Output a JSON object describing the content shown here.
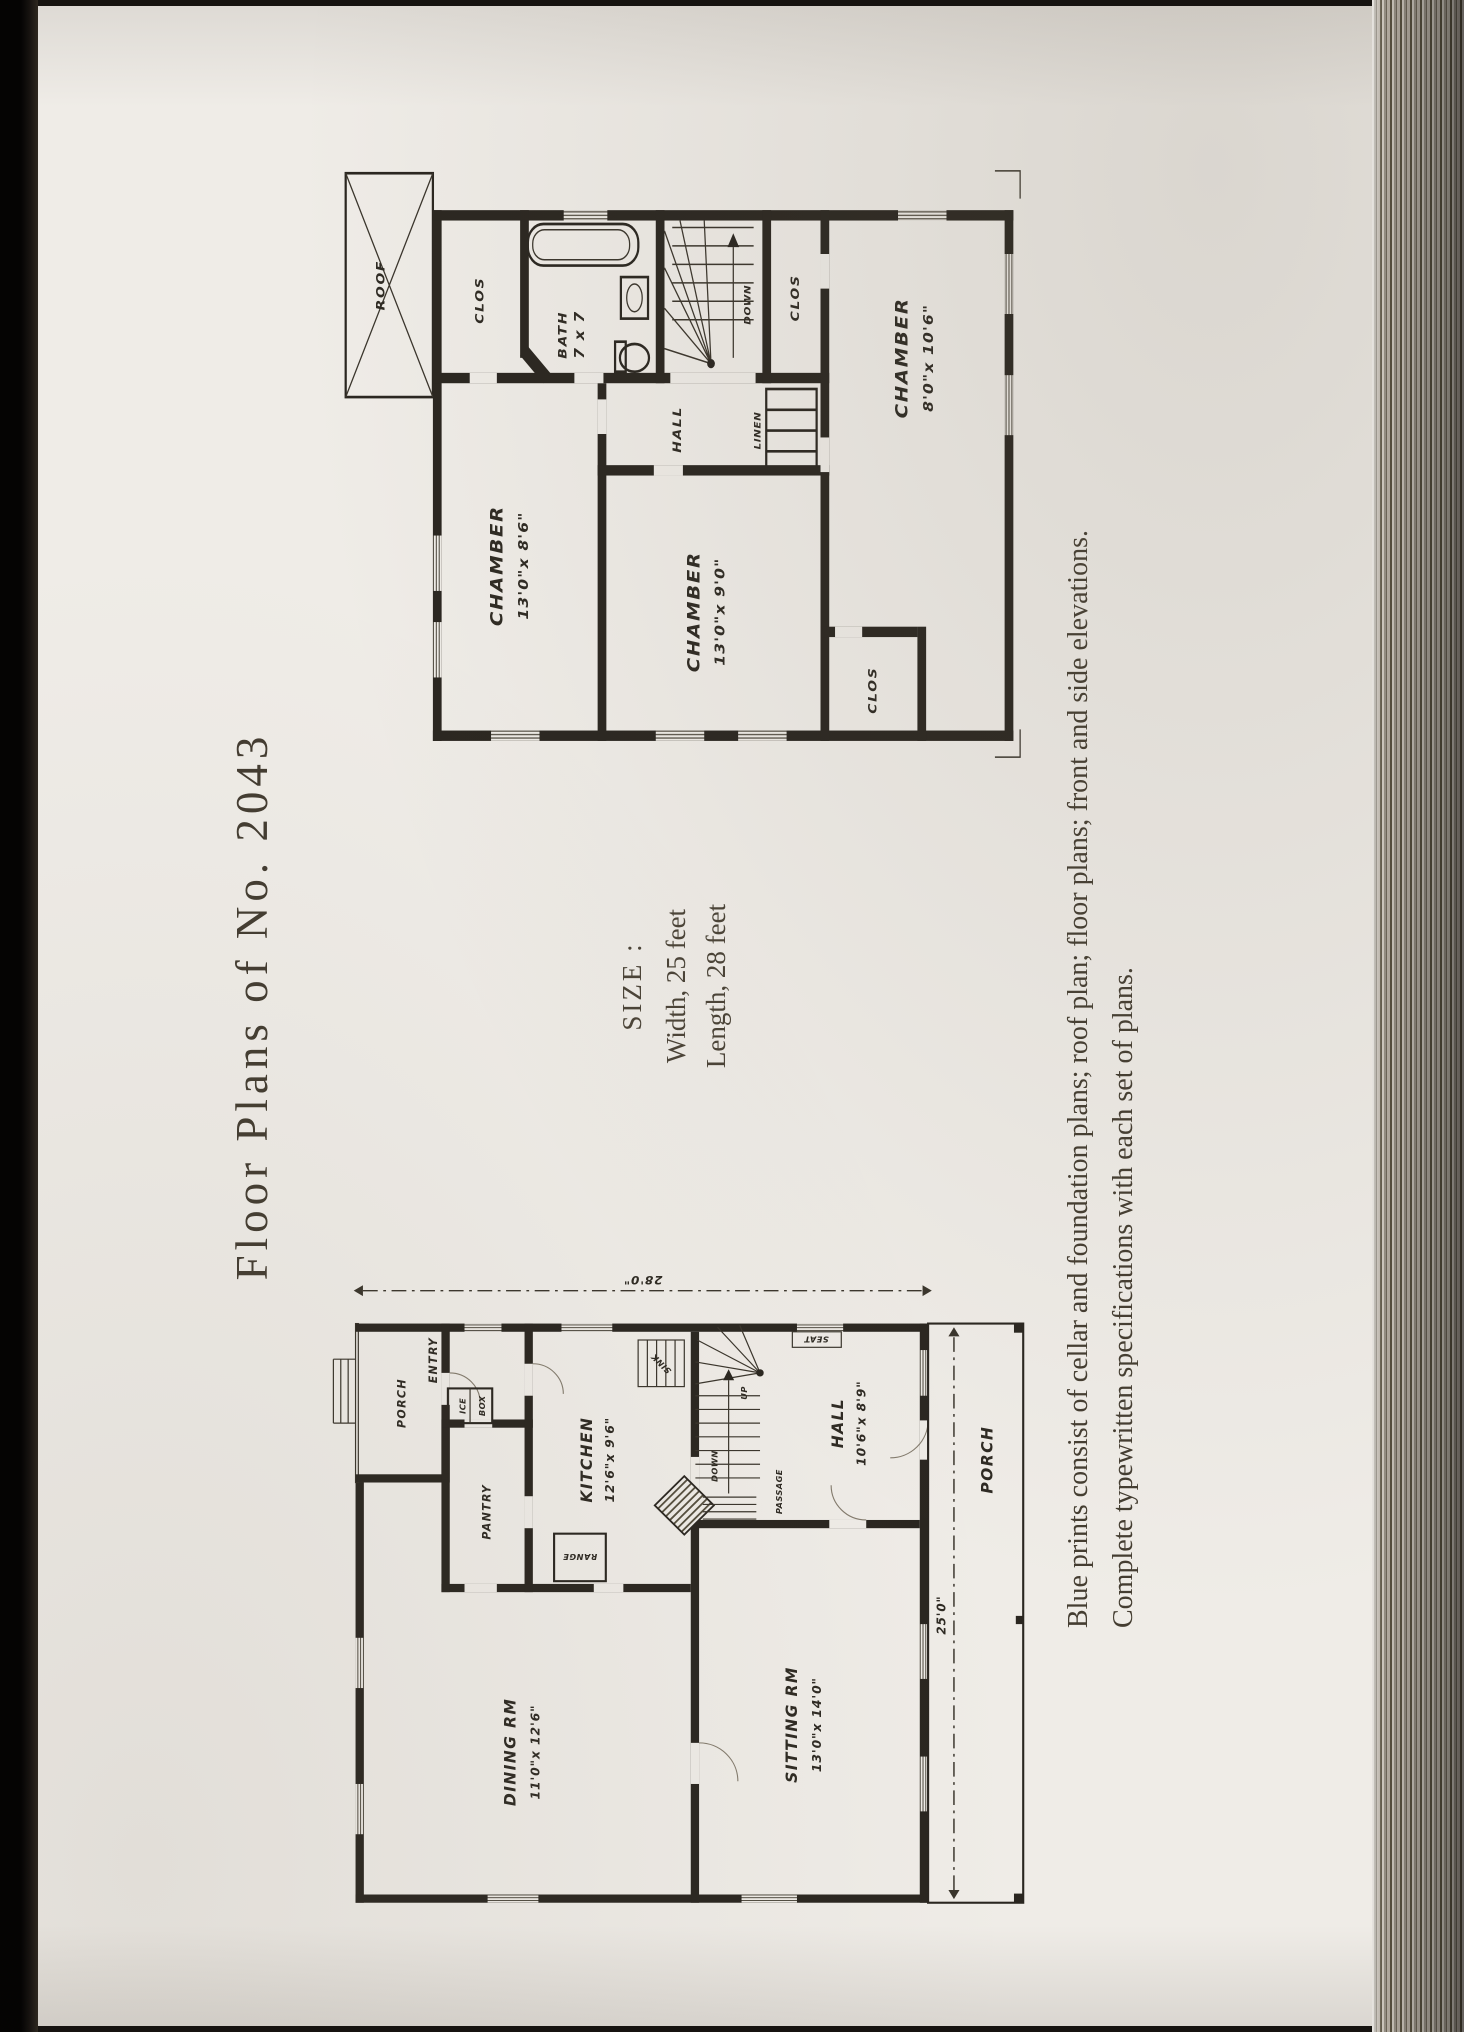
{
  "page": {
    "title": "Floor Plans of No. 2043",
    "size_heading": "SIZE :",
    "size_width": "Width, 25 feet",
    "size_length": "Length, 28 feet",
    "note_line1": "Blue prints consist of cellar and foundation plans; roof plan; floor plans; front and side elevations.",
    "note_line2": "Complete typewritten specifications with each set of plans.",
    "paper_color": "#efece7",
    "ink_color": "#2a2620"
  },
  "second_floor": {
    "roof": "ROOF",
    "clos_a": "CLOS",
    "clos_b": "CLOS",
    "clos_c": "CLOS",
    "bath_name": "BATH",
    "bath_dims": "7 x 7",
    "chamber_a_name": "CHAMBER",
    "chamber_a_dims": "13'0\"x 8'6\"",
    "chamber_b_name": "CHAMBER",
    "chamber_b_dims": "13'0\"x 9'0\"",
    "chamber_c_name": "CHAMBER",
    "chamber_c_dims": "8'0\"x 10'6\"",
    "hall": "HALL",
    "linen": "LINEN",
    "down": "DOWN"
  },
  "first_floor": {
    "porch_rear": "PORCH",
    "entry": "ENTRY",
    "icebox_line1": "ICE",
    "icebox_line2": "BOX",
    "pantry": "PANTRY",
    "kitchen_name": "KITCHEN",
    "kitchen_dims": "12'6\"x 9'6\"",
    "range": "RANGE",
    "sink": "SINK",
    "dining_name": "DINING RM",
    "dining_dims": "11'0\"x 12'6\"",
    "sitting_name": "SITTING RM",
    "sitting_dims": "13'0\"x 14'0\"",
    "hall_name": "HALL",
    "hall_dims": "10'6\"x 8'9\"",
    "passage": "PASSAGE",
    "down": "DOWN",
    "up": "UP",
    "seat": "SEAT",
    "porch_front": "PORCH",
    "dim_width": "25'0\"",
    "dim_length": "28'0\""
  }
}
